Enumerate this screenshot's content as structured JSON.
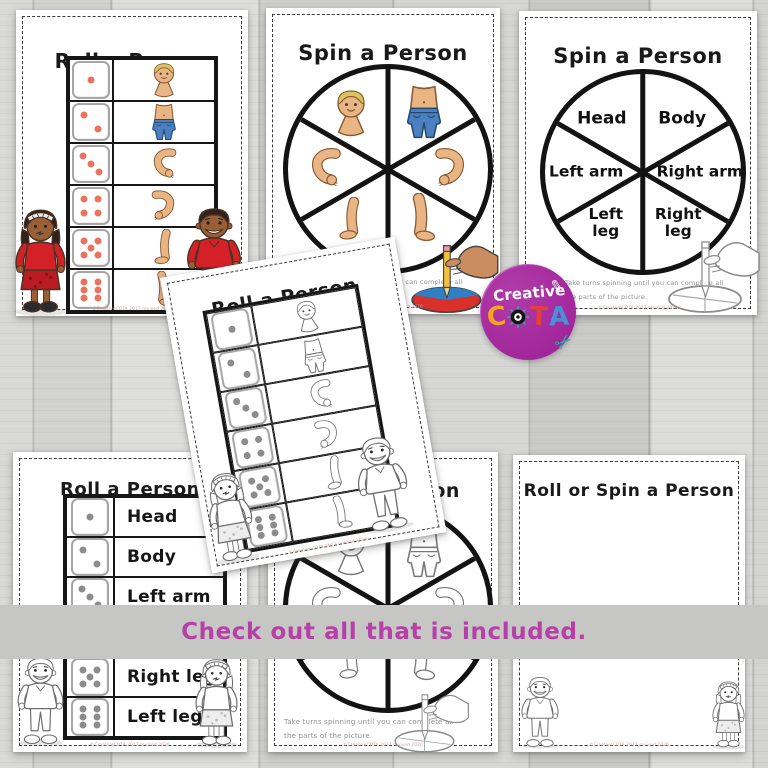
{
  "banner": {
    "text": "Check out all that is included."
  },
  "logo": {
    "word": "Creative",
    "letters": {
      "c": "C",
      "t": "T",
      "a": "A"
    },
    "circle_color": "#a3249f",
    "letter_colors": {
      "c": "#f6a41d",
      "t": "#e2413b",
      "a": "#4a90d9"
    }
  },
  "icons": {
    "pencil": "✎",
    "scissors": "✂"
  },
  "cards": {
    "roll_color": {
      "title": "Roll a Person",
      "rows": [
        {
          "die": 1,
          "part": "head"
        },
        {
          "die": 2,
          "part": "body"
        },
        {
          "die": 3,
          "part": "left-arm"
        },
        {
          "die": 4,
          "part": "right-arm"
        },
        {
          "die": 5,
          "part": "left-leg"
        },
        {
          "die": 6,
          "part": "right-leg"
        }
      ],
      "copyright": "©CreativeCOTA 2017 revised 2020"
    },
    "spin_color": {
      "title": "Spin a Person",
      "wedges": [
        "head",
        "body",
        "left-arm",
        "right-arm",
        "left-leg",
        "right-leg"
      ],
      "instructions_line1": "Take turns spinning until you can complete all",
      "instructions_line2": "the parts of the picture.",
      "copyright": "©CreativeCOTA 2017 revised 2020"
    },
    "spin_text": {
      "title": "Spin a Person",
      "labels": {
        "head": "Head",
        "body": "Body",
        "left_arm": "Left arm",
        "right_arm": "Right arm",
        "left_leg": "Left leg",
        "right_leg": "Right leg"
      },
      "instructions_line1": "Take turns spinning until you can complete all",
      "instructions_line2": "the parts of the picture.",
      "copyright": "©CreativeCOTA 2017 revised 2020"
    },
    "roll_tilted": {
      "title": "Roll a Person",
      "rows": [
        {
          "die": 1,
          "part": "head"
        },
        {
          "die": 2,
          "part": "body"
        },
        {
          "die": 3,
          "part": "left-arm"
        },
        {
          "die": 4,
          "part": "right-arm"
        },
        {
          "die": 5,
          "part": "left-leg"
        },
        {
          "die": 6,
          "part": "right-leg"
        }
      ],
      "copyright": "©CreativeCOTA 2017 revised 2020"
    },
    "roll_text": {
      "title": "Roll a Person",
      "rows": [
        {
          "die": 1,
          "label": "Head"
        },
        {
          "die": 2,
          "label": "Body"
        },
        {
          "die": 3,
          "label": "Left arm"
        },
        {
          "die": 4,
          "label": ""
        },
        {
          "die": 5,
          "label": "Right leg"
        },
        {
          "die": 6,
          "label": "Left leg"
        }
      ],
      "copyright": "©CreativeCOTA 2017 revised 2020"
    },
    "spin_bw": {
      "title": "Spin a Person",
      "instructions_line1": "Take turns spinning until you can complete all",
      "instructions_line2": "the parts of the picture.",
      "copyright": "©CreativeCOTA 2017 revised 2020"
    },
    "roll_or_spin": {
      "title": "Roll or Spin a Person",
      "copyright": "©CreativeCOTA 2017 revised 2020"
    }
  }
}
